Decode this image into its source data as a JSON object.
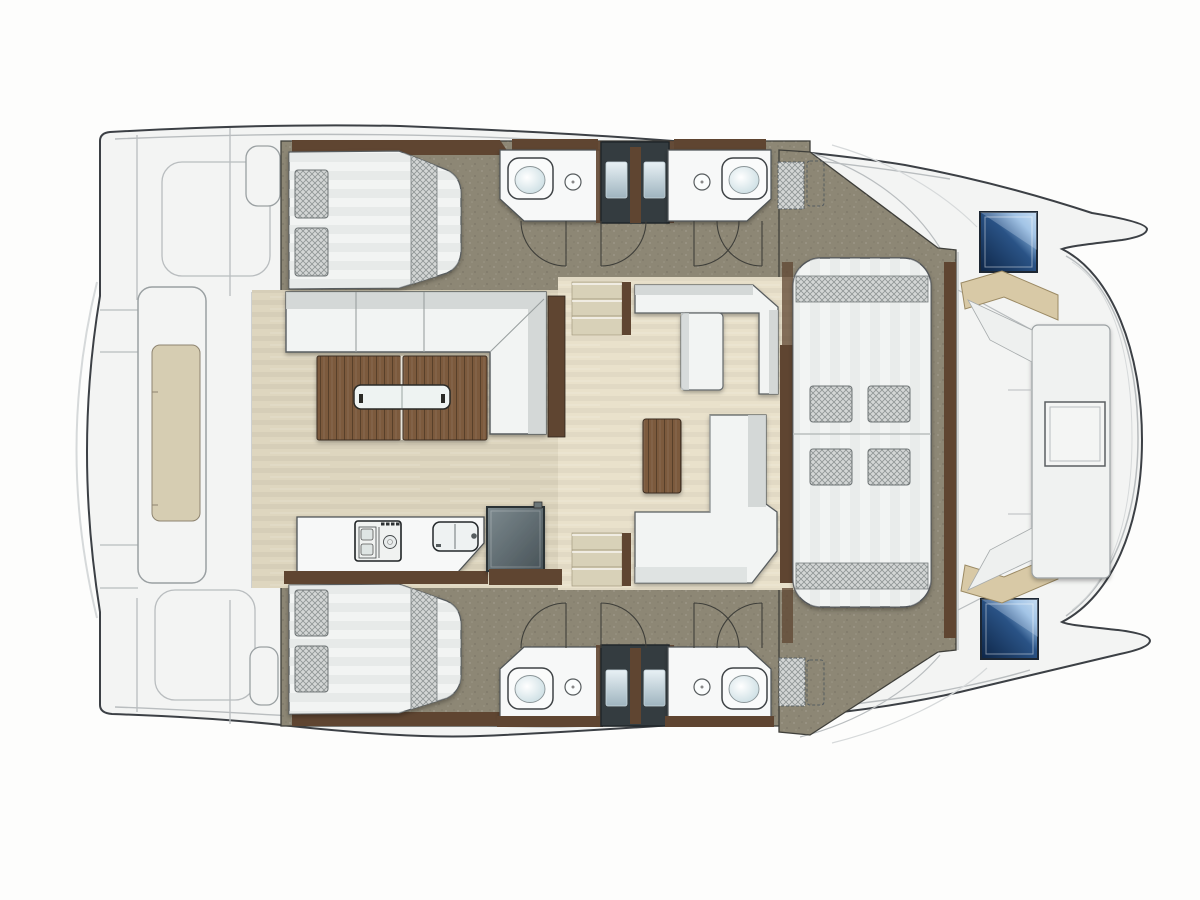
{
  "diagram": {
    "type": "yacht-floor-plan",
    "vessel": "catamaran",
    "view": "top-down deck and accommodation plan",
    "orientation": {
      "bow": "right",
      "stern": "left"
    },
    "rooms": [
      {
        "id": "aft-cabin-port",
        "label": "Port aft cabin with double berth and two pillows"
      },
      {
        "id": "head-port-aft",
        "label": "Port aft bathroom with toilet and washbasin"
      },
      {
        "id": "head-port-fwd",
        "label": "Port forward bathroom with toilet and washbasin"
      },
      {
        "id": "aft-cabin-starboard",
        "label": "Starboard aft cabin with double berth and two pillows"
      },
      {
        "id": "head-starboard-aft",
        "label": "Starboard aft bathroom with toilet and washbasin"
      },
      {
        "id": "head-starboard-fwd",
        "label": "Starboard forward bathroom with toilet and washbasin"
      },
      {
        "id": "cockpit-dining",
        "label": "Aft cockpit dining area with L-shaped sofa and twin-leaf wooden table"
      },
      {
        "id": "saloon",
        "label": "Saloon with corner bench, chaise seat, L-shaped sofa and wooden coffee table"
      },
      {
        "id": "galley",
        "label": "Galley with stove, double sink and refrigerator"
      },
      {
        "id": "forward-lounge",
        "label": "Forward double sunbed lounge with cushions"
      },
      {
        "id": "bow-cockpit",
        "label": "Bow cockpit with U-shaped seating, center table and two deck hatches"
      },
      {
        "id": "stern-platform",
        "label": "Stern platform with teak tender deck between the hulls"
      }
    ],
    "fixtures": {
      "double_berths": 2,
      "sunbeds": 1,
      "toilets": 4,
      "washbasins": 4,
      "galley_stove": 1,
      "galley_sink": 1,
      "refrigerator": 1,
      "companionway_stairs": 2,
      "door_swings": 8,
      "blue_deck_hatches": 2,
      "deck_vents": 2,
      "opening_skylights": 2,
      "cockpit_tables": 1,
      "coffee_tables": 1,
      "bow_tables": 1
    }
  },
  "colors": {
    "background": "#fdfdfc",
    "hull_fill": "#f3f4f3",
    "hull_outline": "#3c4045",
    "deck_seam": "#b9bdbf",
    "deck_seam_light": "#d6d9da",
    "wall_line": "#3f3f3a",
    "cabin_floor": "#8d8775",
    "saloon_floor": "#e9e1cb",
    "cockpit_floor": "#ded6bf",
    "wood_dark": "#5f4531",
    "wood_table": "#7b5a3d",
    "furniture_white": "#f2f4f3",
    "furniture_stroke": "#595d5f",
    "furniture_shade": "#d0d5d4",
    "step_beige": "#d8d1b8",
    "mattress_stripe": "#dde1e0",
    "crosshatch_bg": "#d3d6d5",
    "crosshatch_line": "#8f9595",
    "charcoal": "#343c40",
    "hatch_navy": "#0d2546",
    "hatch_light": "#c3dcf2",
    "tan_cushion": "#d8c9a6",
    "fridge_dark": "#475257",
    "platform_teak": "#d6cdb2",
    "toilet_tint": "#c2d8de"
  }
}
